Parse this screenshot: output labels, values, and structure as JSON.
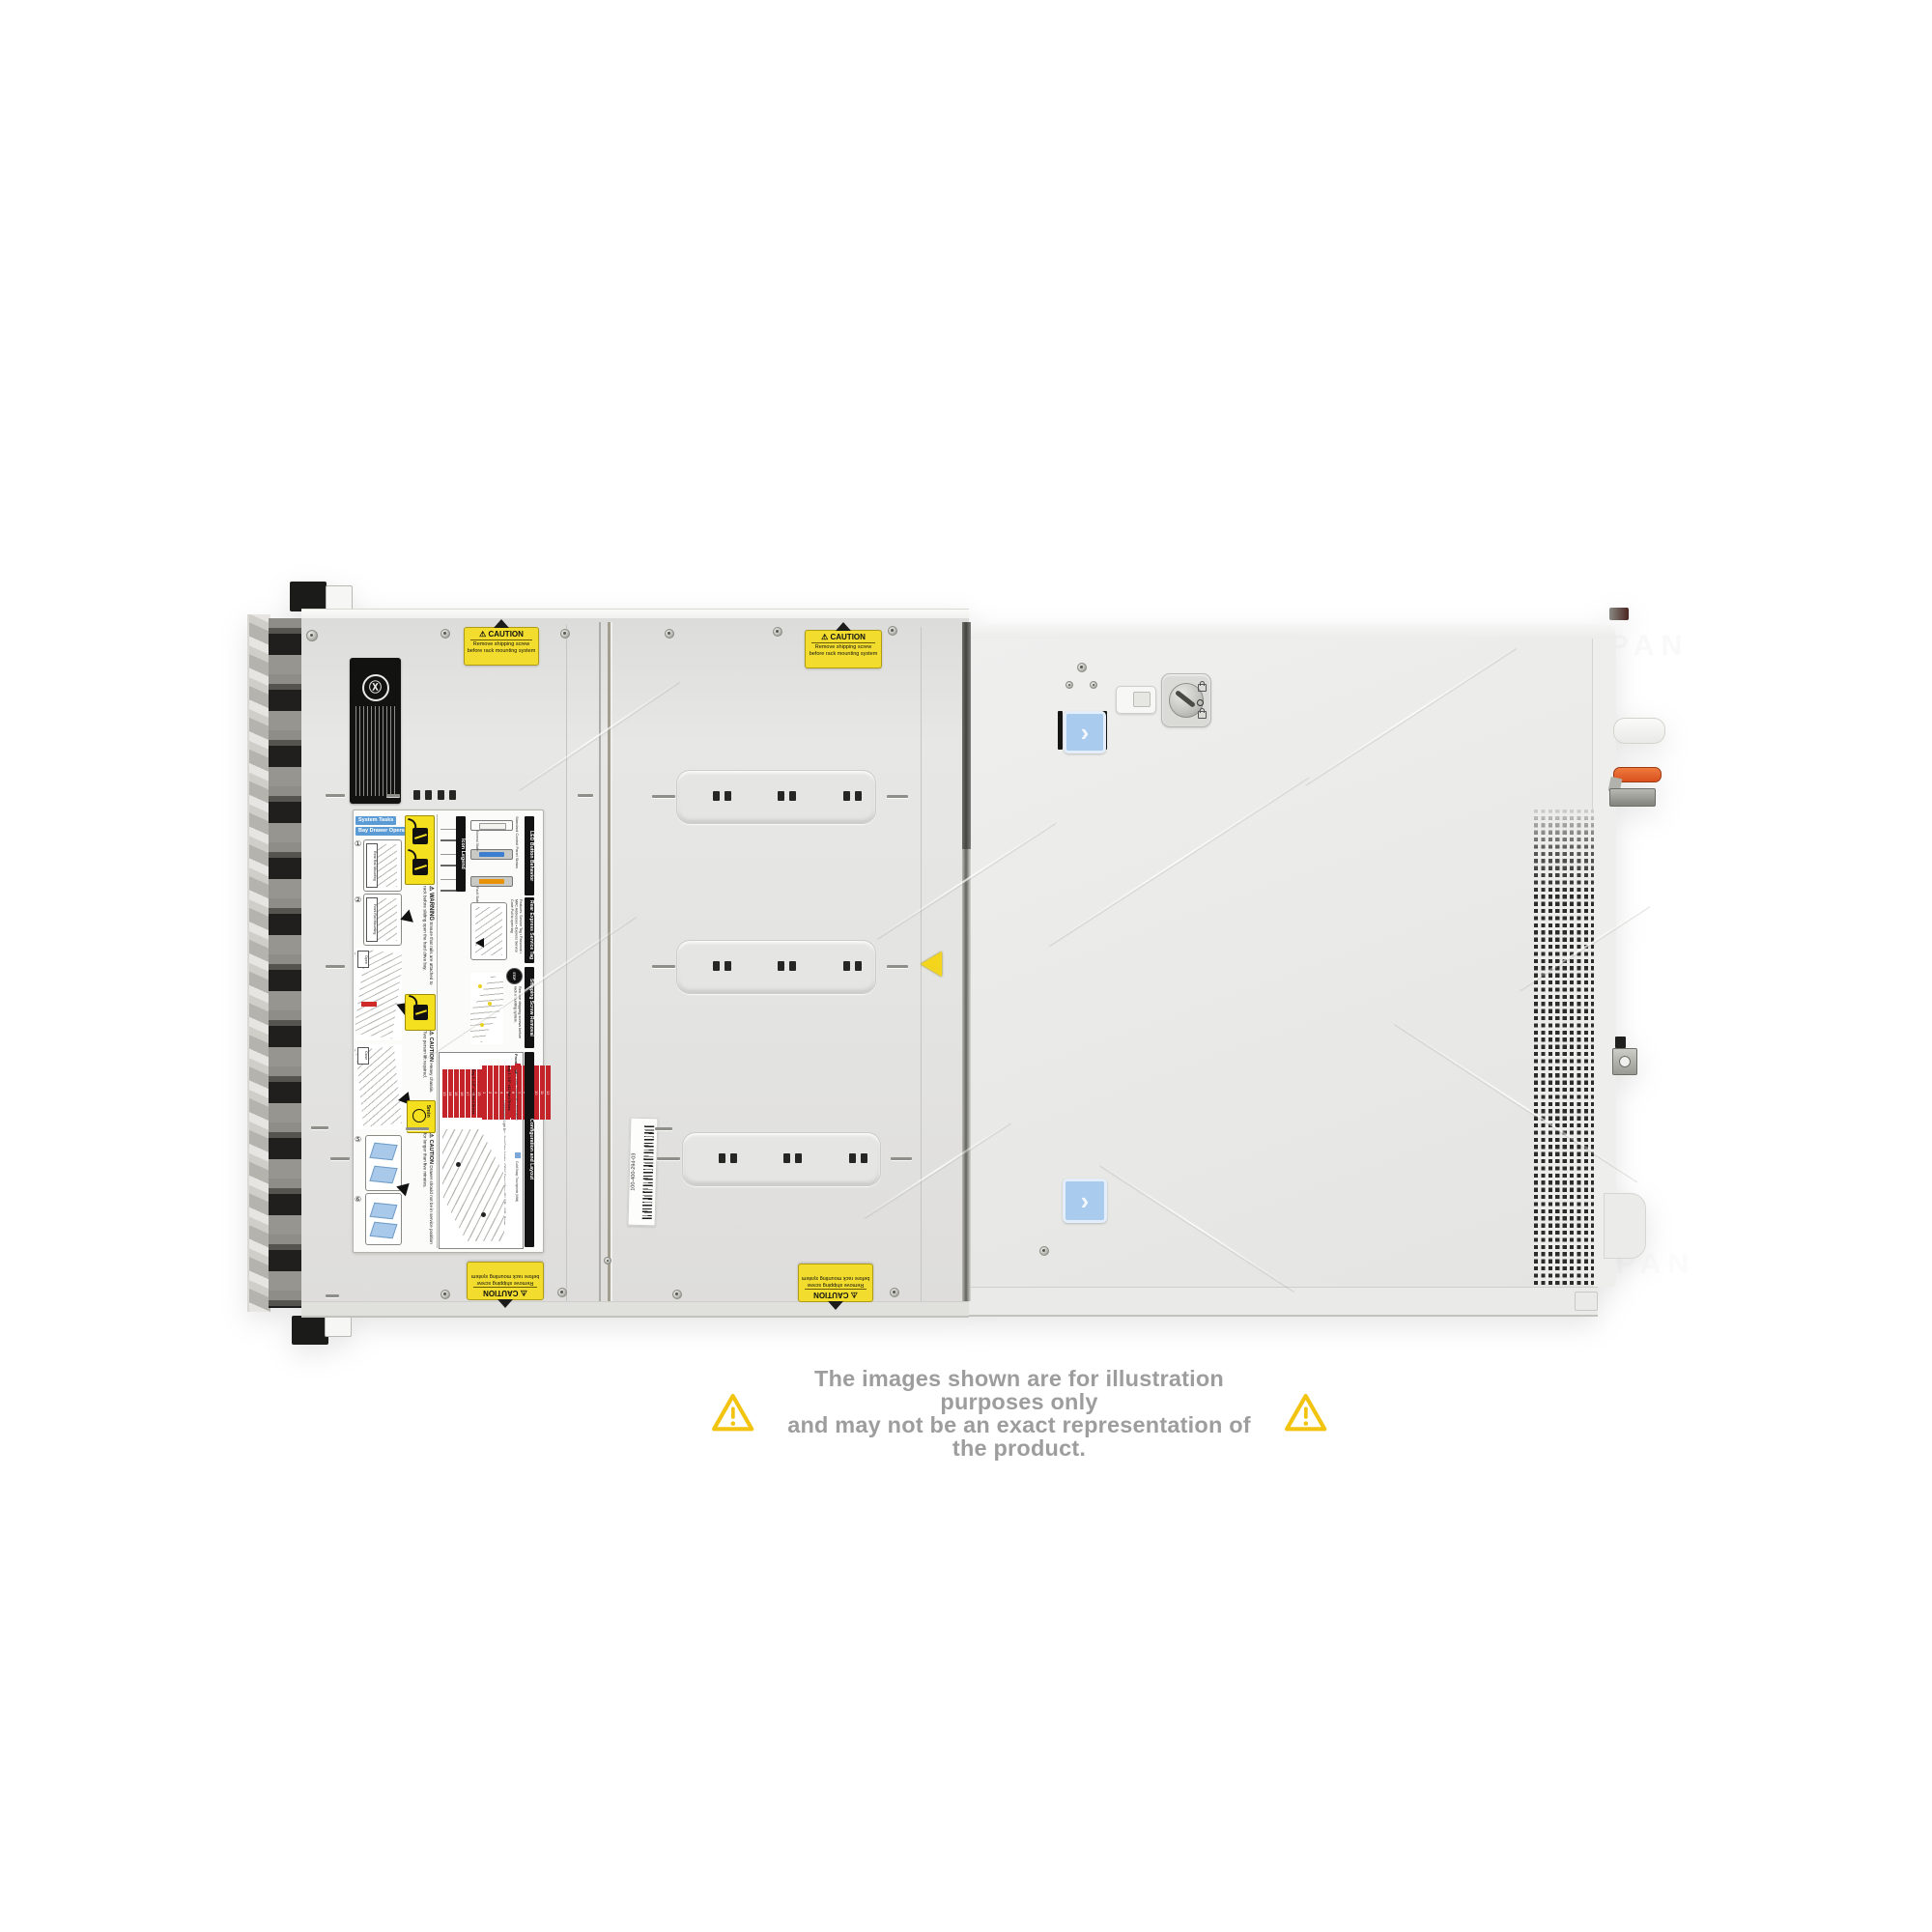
{
  "watermark": {
    "text": "COMPAN"
  },
  "disclaimer": {
    "line1": "The images shown are for illustration purposes only",
    "line2": "and may not be an exact representation of the product.",
    "text_color": "#9d9d9d",
    "triangle_color": "#f2c410"
  },
  "server": {
    "caution_sticker": {
      "title": "⚠ CAUTION",
      "line1": "Remove shipping screw",
      "line2": "before rack mounting system"
    },
    "barcode_label": "100-400-294-03",
    "chevron_icon": "›",
    "service_label": {
      "chips": {
        "c1": "System Tasks",
        "c2": "Bay Drawer Operation"
      },
      "steps": [
        "①",
        "②",
        "③",
        "④",
        "⑤",
        "⑥"
      ],
      "rail_tags": {
        "t1": "Rear Rail Mounting",
        "t2": "Front Rail Mounting",
        "open": "Open",
        "close": "Close"
      },
      "icon_legend": {
        "title": "Icon Legend",
        "items": [
          "System ID",
          "iDRAC Direct (Micro-AB USB)",
          "USB 2.0"
        ]
      },
      "led": {
        "title": "LED Button Behavior",
        "subtitle": "Standard Control Panel Status",
        "normal": "Normal State",
        "fault": "Fault State"
      },
      "rear_tag": {
        "title": "Rear Express Service Tag",
        "features_label": "Features:",
        "features": [
          "Service Tag",
          "Password",
          "MAC Addresses",
          "Express Service Code"
        ],
        "pull_note": "Pull to open tag"
      },
      "shipping": {
        "title": "Shipping Screw Removal",
        "stop": "STOP",
        "text": "Remove shipping screws before rack mounting system."
      },
      "warning": {
        "title": "⚠ WARNING",
        "text": "Ensure that rails are attached to rack before sliding open the hard drive bay."
      },
      "caution_heavy": {
        "title": "⚠ CAUTION",
        "text": "Heavy chassis. Two person lift required."
      },
      "caution_drawer": {
        "title": "⚠ CAUTION",
        "text": "Drawer should not be in service position for longer than five minutes."
      },
      "five_min": "5min",
      "config": {
        "title": "Configuration and Layout",
        "legend_hot": "Hot Swap Touchpoints (Immediate)",
        "legend_cold": "Cold Swap Touchpoints (Mild)",
        "front_view": "Front View",
        "bay1_label": "Bay 1: 3.5\" x12 Hard Drives",
        "bay2_label": "Bay 2: 3.5\" x12 Hard Drives",
        "bay1_numbers": [
          1,
          2,
          3,
          4,
          5,
          6,
          7,
          8,
          9,
          10,
          11,
          12
        ],
        "bay2_numbers": [
          13,
          14,
          15,
          16,
          17,
          18,
          19,
          20,
          21,
          22,
          23,
          24
        ],
        "side_labels": [
          "Control/Status Light Bar",
          "Hard Drive Activity",
          "iDRAC Direct (Micro-AB USB)",
          "USB",
          "Power"
        ]
      }
    }
  }
}
